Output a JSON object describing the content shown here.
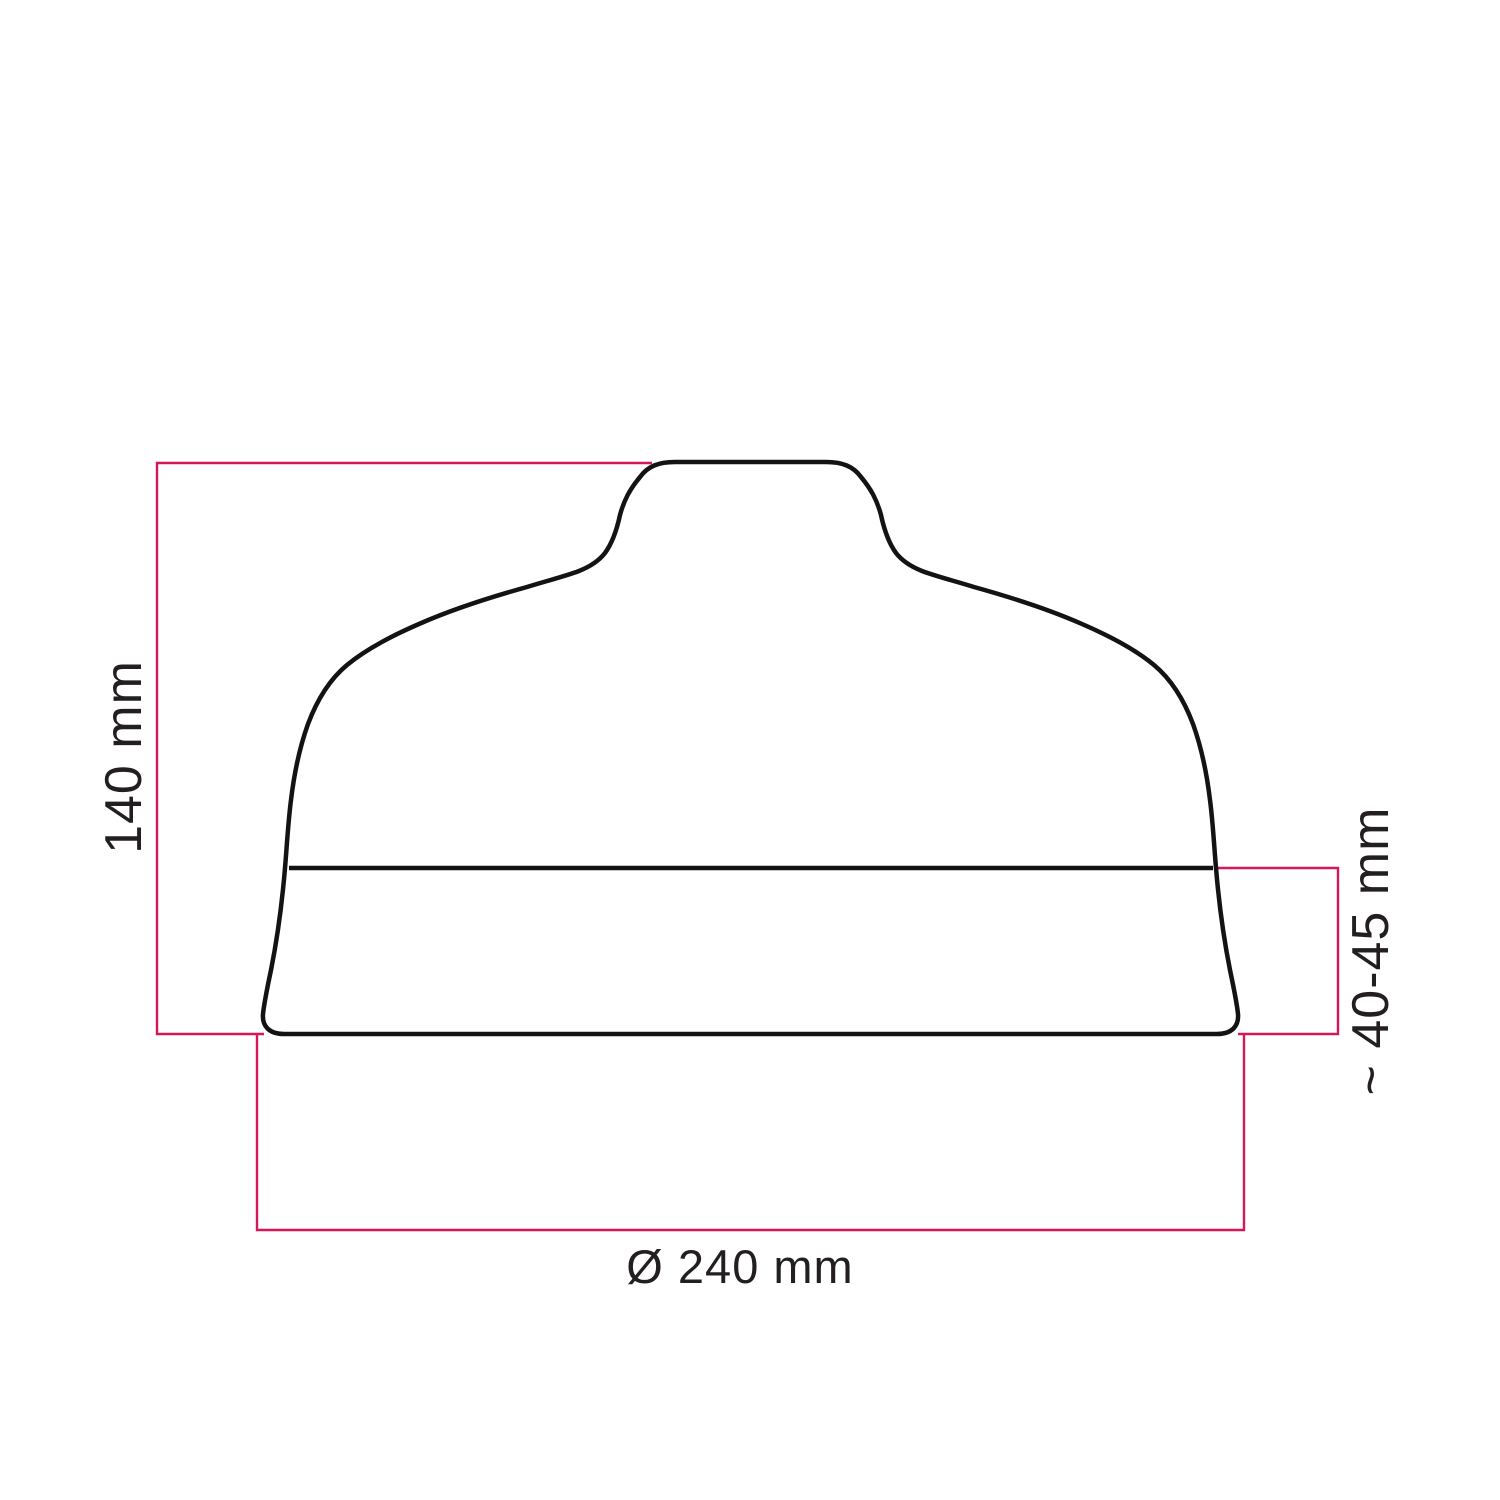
{
  "colors": {
    "background": "#ffffff",
    "outline": "#131313",
    "dimension": "#d4175a",
    "text": "#231f20"
  },
  "diagram": {
    "kind": "lampshade-dimension-drawing",
    "labels": {
      "height": "140 mm",
      "edge": "~ 40-45 mm",
      "diameter": "Ø 240 mm"
    }
  }
}
